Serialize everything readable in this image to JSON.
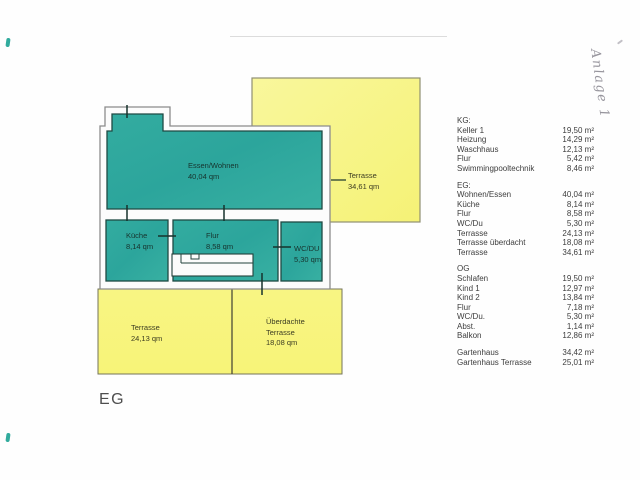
{
  "page": {
    "floor_label": "EG",
    "handwritten_note": "Anlage 1"
  },
  "plan": {
    "rooms": {
      "living": {
        "name": "Essen/Wohnen",
        "area": "40,04 qm"
      },
      "kitchen": {
        "name": "Küche",
        "area": "8,14 qm"
      },
      "hall": {
        "name": "Flur",
        "area": "8,58 qm"
      },
      "wc": {
        "name": "WC/DU",
        "area": "5,30 qm"
      }
    },
    "terraces": {
      "top": {
        "name": "Terrasse",
        "area": "34,61 qm"
      },
      "bottom": {
        "name": "Terrasse",
        "area": "24,13 qm"
      },
      "covered": {
        "name_line1": "Überdachte",
        "name_line2": "Terrasse",
        "area": "18,08 qm"
      }
    },
    "colors": {
      "room_fill": "#2FA89E",
      "terrace_fill": "#F6F37E",
      "wall_outline": "#8C8C8C",
      "room_border": "#1E4A43"
    }
  },
  "legend": {
    "sections": [
      {
        "title": "KG:",
        "items": [
          {
            "name": "Keller 1",
            "area": "19,50 m²"
          },
          {
            "name": "Heizung",
            "area": "14,29 m²"
          },
          {
            "name": "Waschhaus",
            "area": "12,13 m²"
          },
          {
            "name": "Flur",
            "area": "5,42 m²"
          },
          {
            "name": "Swimmingpooltechnik",
            "area": "8,46 m²"
          }
        ]
      },
      {
        "title": "EG:",
        "items": [
          {
            "name": "Wohnen/Essen",
            "area": "40,04 m²"
          },
          {
            "name": "Küche",
            "area": "8,14 m²"
          },
          {
            "name": "Flur",
            "area": "8,58 m²"
          },
          {
            "name": "WC/Du",
            "area": "5,30 m²"
          },
          {
            "name": "Terrasse",
            "area": "24,13 m²"
          },
          {
            "name": "Terrasse überdacht",
            "area": "18,08 m²"
          },
          {
            "name": "Terrasse",
            "area": "34,61 m²"
          }
        ]
      },
      {
        "title": "OG",
        "items": [
          {
            "name": "Schlafen",
            "area": "19,50 m²"
          },
          {
            "name": "Kind 1",
            "area": "12,97 m²"
          },
          {
            "name": "Kind 2",
            "area": "13,84 m²"
          },
          {
            "name": "Flur",
            "area": "7,18 m²"
          },
          {
            "name": "WC/Du.",
            "area": "5,30 m²"
          },
          {
            "name": "Abst.",
            "area": "1,14 m²"
          },
          {
            "name": "Balkon",
            "area": "12,86 m²"
          }
        ]
      },
      {
        "title": "",
        "items": [
          {
            "name": "Gartenhaus",
            "area": "34,42 m²"
          },
          {
            "name": "Gartenhaus Terrasse",
            "area": "25,01 m²"
          }
        ]
      }
    ]
  }
}
